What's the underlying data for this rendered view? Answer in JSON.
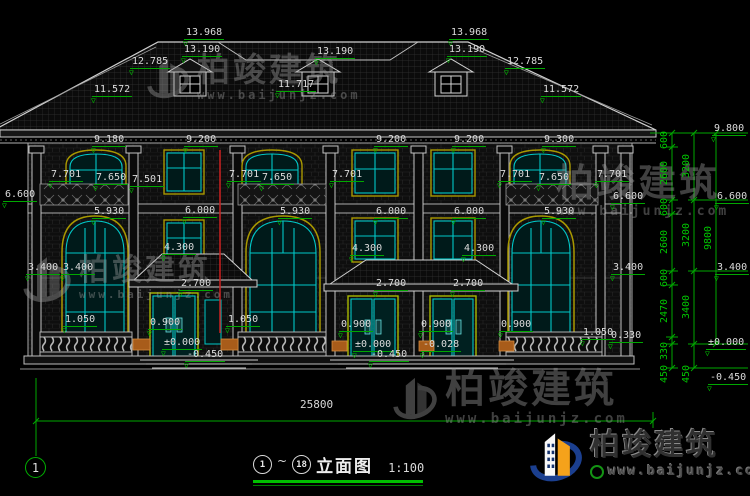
{
  "drawing": {
    "title": {
      "axis_start": "1",
      "separator": "~",
      "axis_end": "18",
      "name": "立面图",
      "scale": "1:100"
    },
    "axis_bubble_label": "1",
    "total_width_dim": "25800"
  },
  "watermark": {
    "brand": "柏竣建筑",
    "url": "www.baijunjz.com"
  },
  "logo": {
    "brand": "柏竣建筑",
    "url": "www.baijunjz.com"
  },
  "colors": {
    "background": "#000000",
    "linework": "#c8c8c8",
    "window": "#00c8c8",
    "window_trim": "#a89800",
    "dimension": "#00b400",
    "level_text": "#dcdcdc",
    "pipe": "#cc2020",
    "flower_box": "#a85c1a",
    "logo_blue": "#1b3f8f",
    "logo_orange": "#f5a21b"
  },
  "labels": {
    "levels": [
      {
        "t": "13.968",
        "x": 184,
        "y": 27
      },
      {
        "t": "13.190",
        "x": 182,
        "y": 44
      },
      {
        "t": "12.785",
        "x": 130,
        "y": 56
      },
      {
        "t": "11.572",
        "x": 92,
        "y": 84
      },
      {
        "t": "11.717",
        "x": 276,
        "y": 79
      },
      {
        "t": "13.190",
        "x": 315,
        "y": 46
      },
      {
        "t": "13.968",
        "x": 449,
        "y": 27
      },
      {
        "t": "13.190",
        "x": 447,
        "y": 44
      },
      {
        "t": "12.785",
        "x": 505,
        "y": 56
      },
      {
        "t": "11.572",
        "x": 541,
        "y": 84
      },
      {
        "t": "9.180",
        "x": 92,
        "y": 134
      },
      {
        "t": "9.200",
        "x": 184,
        "y": 134
      },
      {
        "t": "9.200",
        "x": 374,
        "y": 134
      },
      {
        "t": "9.200",
        "x": 452,
        "y": 134
      },
      {
        "t": "9.300",
        "x": 542,
        "y": 134
      },
      {
        "t": "7.701",
        "x": 49,
        "y": 169
      },
      {
        "t": "7.650",
        "x": 94,
        "y": 172
      },
      {
        "t": "7.501",
        "x": 130,
        "y": 174
      },
      {
        "t": "7.701",
        "x": 227,
        "y": 169
      },
      {
        "t": "7.650",
        "x": 260,
        "y": 172
      },
      {
        "t": "7.701",
        "x": 330,
        "y": 169
      },
      {
        "t": "7.701",
        "x": 498,
        "y": 169
      },
      {
        "t": "7.650",
        "x": 537,
        "y": 172
      },
      {
        "t": "7.701",
        "x": 595,
        "y": 169
      },
      {
        "t": "6.600",
        "x": 3,
        "y": 189
      },
      {
        "t": "6.600",
        "x": 611,
        "y": 191
      },
      {
        "t": "5.930",
        "x": 92,
        "y": 206
      },
      {
        "t": "6.000",
        "x": 183,
        "y": 205
      },
      {
        "t": "5.930",
        "x": 278,
        "y": 206
      },
      {
        "t": "6.000",
        "x": 374,
        "y": 206
      },
      {
        "t": "6.000",
        "x": 452,
        "y": 206
      },
      {
        "t": "5.930",
        "x": 542,
        "y": 206
      },
      {
        "t": "4.300",
        "x": 162,
        "y": 242
      },
      {
        "t": "4.300",
        "x": 350,
        "y": 243
      },
      {
        "t": "4.300",
        "x": 462,
        "y": 243
      },
      {
        "t": "3.400",
        "x": 26,
        "y": 262
      },
      {
        "t": "3.400",
        "x": 61,
        "y": 262
      },
      {
        "t": "3.400",
        "x": 611,
        "y": 262
      },
      {
        "t": "2.700",
        "x": 179,
        "y": 278
      },
      {
        "t": "2.700",
        "x": 374,
        "y": 278
      },
      {
        "t": "2.700",
        "x": 451,
        "y": 278
      },
      {
        "t": "1.050",
        "x": 63,
        "y": 314
      },
      {
        "t": "1.050",
        "x": 226,
        "y": 314
      },
      {
        "t": "1.050",
        "x": 581,
        "y": 327
      },
      {
        "t": "0.900",
        "x": 148,
        "y": 317
      },
      {
        "t": "0.900",
        "x": 339,
        "y": 319
      },
      {
        "t": "0.900",
        "x": 419,
        "y": 319
      },
      {
        "t": "0.900",
        "x": 499,
        "y": 319
      },
      {
        "t": "0.330",
        "x": 609,
        "y": 330
      },
      {
        "t": "±0.000",
        "x": 162,
        "y": 337
      },
      {
        "t": "-0.450",
        "x": 185,
        "y": 349
      },
      {
        "t": "±0.000",
        "x": 353,
        "y": 339
      },
      {
        "t": "-0.028",
        "x": 421,
        "y": 339
      },
      {
        "t": "-0.450",
        "x": 369,
        "y": 349
      },
      {
        "t": "9.800",
        "x": 712,
        "y": 123
      },
      {
        "t": "6.600",
        "x": 715,
        "y": 191
      },
      {
        "t": "3.400",
        "x": 715,
        "y": 262
      },
      {
        "t": "±0.000",
        "x": 706,
        "y": 337
      },
      {
        "t": "-0.450",
        "x": 708,
        "y": 372
      }
    ],
    "chain": [
      {
        "t": "600",
        "x": 665,
        "y": 140
      },
      {
        "t": "2600",
        "x": 665,
        "y": 173
      },
      {
        "t": "600",
        "x": 665,
        "y": 207
      },
      {
        "t": "2600",
        "x": 665,
        "y": 242
      },
      {
        "t": "600",
        "x": 665,
        "y": 278
      },
      {
        "t": "2470",
        "x": 665,
        "y": 311
      },
      {
        "t": "330",
        "x": 665,
        "y": 351
      },
      {
        "t": "450",
        "x": 665,
        "y": 374
      },
      {
        "t": "3200",
        "x": 687,
        "y": 166
      },
      {
        "t": "3200",
        "x": 687,
        "y": 235
      },
      {
        "t": "3400",
        "x": 687,
        "y": 307
      },
      {
        "t": "450",
        "x": 687,
        "y": 374
      },
      {
        "t": "9800",
        "x": 709,
        "y": 238
      }
    ]
  }
}
